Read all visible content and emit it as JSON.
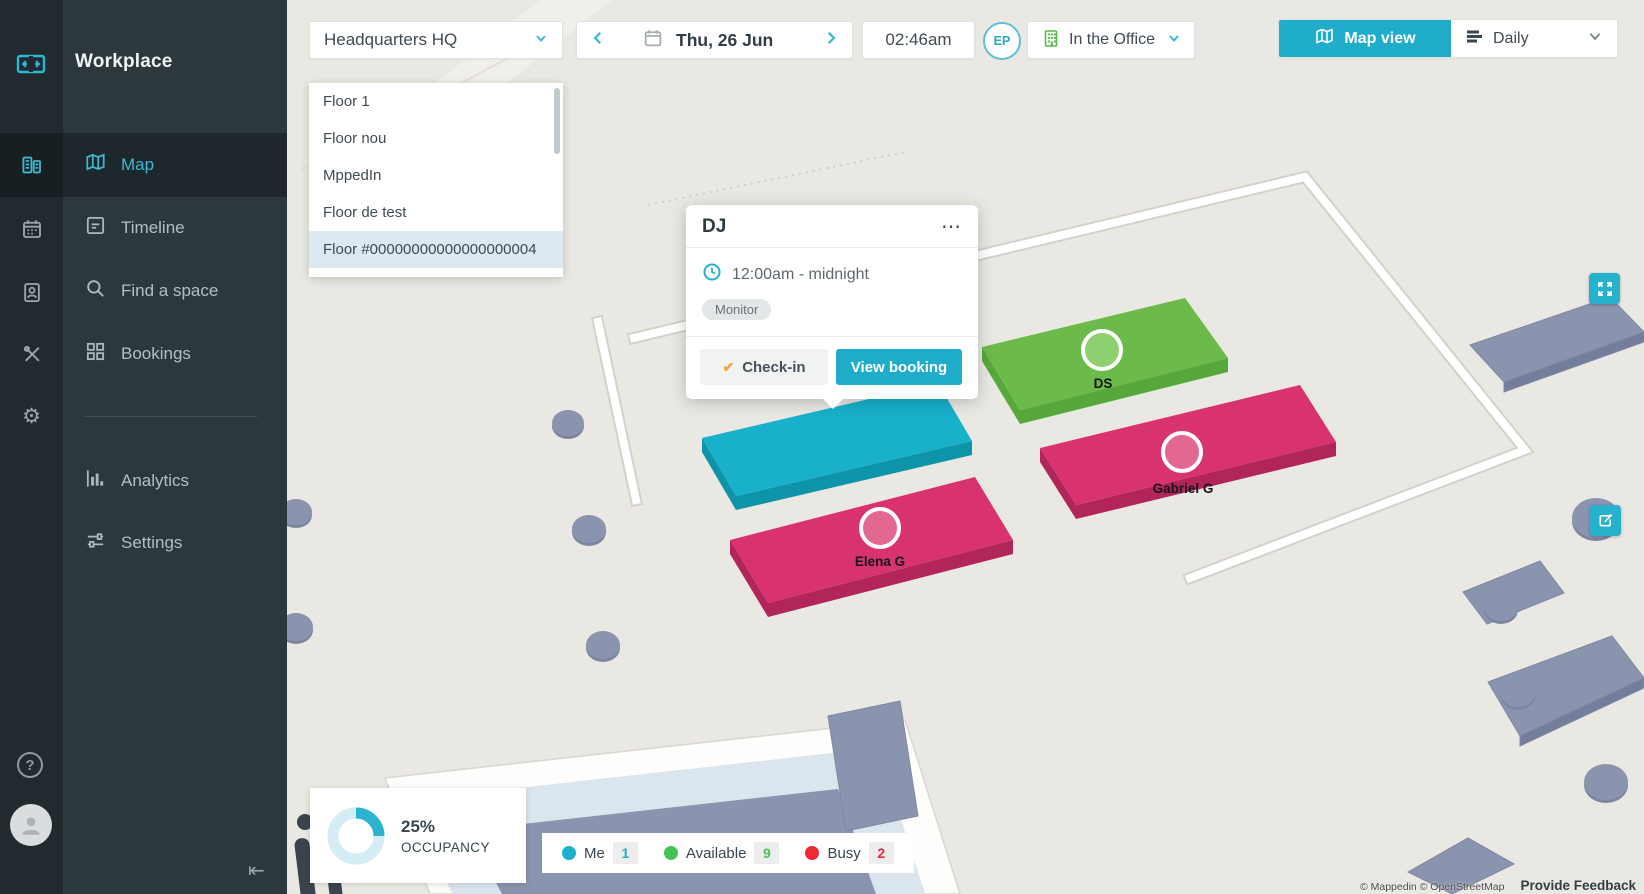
{
  "app": {
    "title": "Workplace"
  },
  "sidebar": {
    "items": [
      {
        "label": "Map",
        "active": true
      },
      {
        "label": "Timeline"
      },
      {
        "label": "Find a space"
      },
      {
        "label": "Bookings"
      },
      {
        "label": "Analytics"
      },
      {
        "label": "Settings"
      }
    ]
  },
  "topbar": {
    "building_selector": "Headquarters HQ",
    "date": "Thu, 26 Jun",
    "time": "02:46am",
    "user_initials": "EP",
    "presence_status": "In the Office",
    "view_toggle": {
      "map_label": "Map view",
      "schedule_label": "Daily"
    }
  },
  "floor_panel": {
    "items": [
      "Floor 1",
      "Floor nou",
      "MppedIn",
      "Floor de test",
      "Floor #00000000000000000004"
    ],
    "selected_index": 4
  },
  "booking_popup": {
    "title": "DJ",
    "time_range": "12:00am - midnight",
    "asset_tag": "Monitor",
    "checkin_label": "Check-in",
    "view_booking_label": "View booking"
  },
  "map": {
    "desks": [
      {
        "label": "DS",
        "status": "available",
        "top_color": "#6cba4a",
        "side_color": "#57a83b",
        "marker_color": "#8ecf70"
      },
      {
        "label": "Gabriel G",
        "status": "busy",
        "top_color": "#d8336f",
        "side_color": "#b2255a",
        "marker_color": "#e2688f"
      },
      {
        "label": "Elena G",
        "status": "busy",
        "top_color": "#d8336f",
        "side_color": "#b2255a",
        "marker_color": "#e2688f"
      },
      {
        "label": "",
        "status": "me",
        "top_color": "#18b0ca",
        "side_color": "#0e94a9"
      }
    ]
  },
  "occupancy": {
    "percent": "25%",
    "percent_value": 25,
    "label": "OCCUPANCY"
  },
  "legend": {
    "items": [
      {
        "label": "Me",
        "count": "1",
        "color": "#1cb0cc"
      },
      {
        "label": "Available",
        "count": "9",
        "color": "#47c353"
      },
      {
        "label": "Busy",
        "count": "2",
        "color": "#ee2a35"
      }
    ]
  },
  "attribution": {
    "copyright": "© Mappedin © OpenStreetMap",
    "feedback": "Provide Feedback"
  },
  "icons": {
    "more": "⋯",
    "check": "✔",
    "help": "?",
    "collapse": "⇤"
  },
  "colors": {
    "accent": "#26b2cc",
    "sidebar": "#2d383d",
    "map_background": "#eae8e2",
    "presence_green": "#56b949"
  }
}
